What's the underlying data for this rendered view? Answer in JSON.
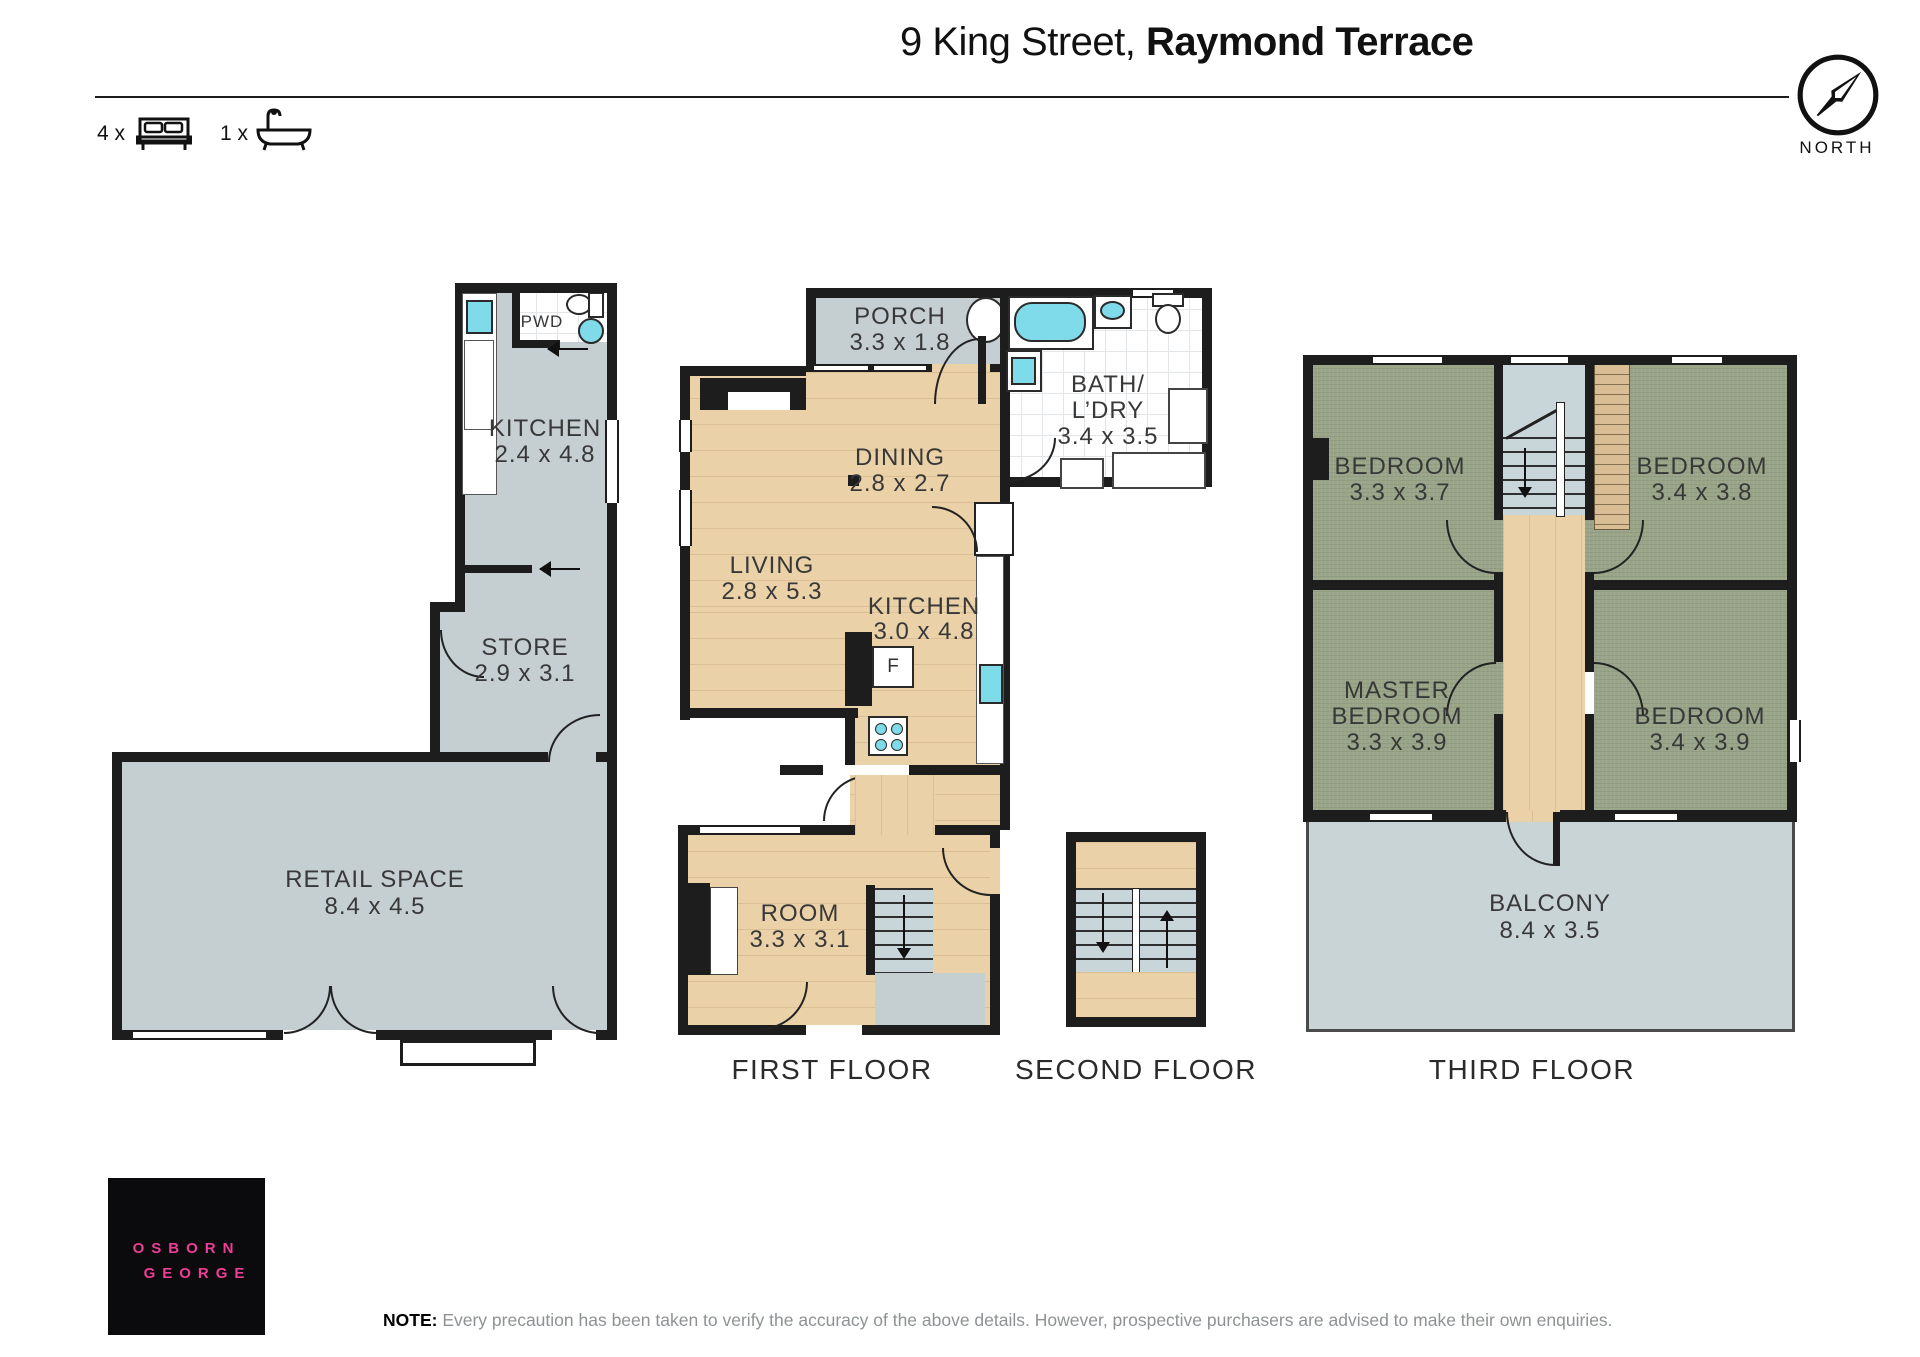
{
  "header": {
    "title_regular": "9 King Street, ",
    "title_bold": "Raymond Terrace",
    "bed_count_label": "4 x",
    "bath_count_label": "1 x",
    "compass_label": "NORTH"
  },
  "floor_labels": {
    "first": "FIRST FLOOR",
    "second": "SECOND FLOOR",
    "third": "THIRD FLOOR"
  },
  "rooms": {
    "pwd": {
      "name": "PWD"
    },
    "shop_kitchen": {
      "name": "KITCHEN",
      "dims": "2.4 x 4.8"
    },
    "store": {
      "name": "STORE",
      "dims": "2.9 x 3.1"
    },
    "retail": {
      "name": "RETAIL SPACE",
      "dims": "8.4 x 4.5"
    },
    "porch": {
      "name": "PORCH",
      "dims": "3.3 x 1.8"
    },
    "bath": {
      "line1": "BATH/",
      "line2": "L’DRY",
      "dims": "3.4 x 3.5"
    },
    "dining": {
      "name": "DINING",
      "dims": "2.8 x 2.7"
    },
    "living": {
      "name": "LIVING",
      "dims": "2.8 x 5.3"
    },
    "kitchen": {
      "name": "KITCHEN",
      "dims": "3.0 x 4.8"
    },
    "fridge_label": "F",
    "room": {
      "name": "ROOM",
      "dims": "3.3 x 3.1"
    },
    "bedroom1": {
      "name": "BEDROOM",
      "dims": "3.3 x 3.7"
    },
    "bedroom2": {
      "name": "BEDROOM",
      "dims": "3.4 x 3.8"
    },
    "master": {
      "line1": "MASTER",
      "line2": "BEDROOM",
      "dims": "3.3 x 3.9"
    },
    "bedroom3": {
      "name": "BEDROOM",
      "dims": "3.4 x 3.9"
    },
    "balcony": {
      "name": "BALCONY",
      "dims": "8.4 x 3.5"
    }
  },
  "branding": {
    "logo_line1": "OSBORN",
    "logo_line2": "GEORGE"
  },
  "note": {
    "label": "NOTE:",
    "text": " Every precaution has been taken to verify the accuracy of the above details. However, prospective purchasers are advised to make their own enquiries."
  },
  "colors": {
    "floor_gray": "#c5cfd2",
    "wood": "#ebd1a8",
    "carpet_green": "#99a489",
    "stair_blue": "#c9d6d9",
    "wall": "#1d1d1d",
    "fixture_cyan": "#7fdbe9",
    "wardrobe_tan": "#d9bd94",
    "balcony_gray": "#c9d4d7",
    "logo_pink": "#ee3d96"
  }
}
